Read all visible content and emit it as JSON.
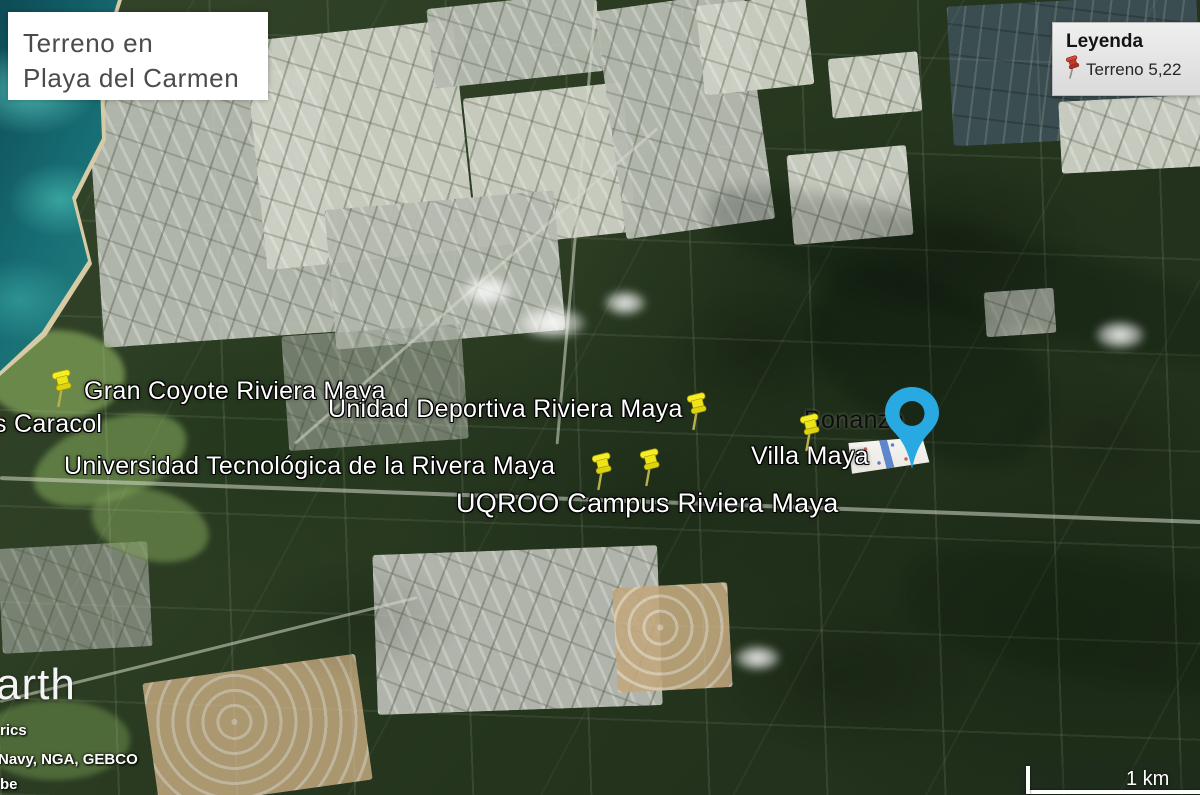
{
  "title_card": {
    "line1": "Terreno en",
    "line2": "Playa del Carmen"
  },
  "legend": {
    "title": "Leyenda",
    "item_label": "Terreno 5,22"
  },
  "map_labels": {
    "gran_coyote": "Gran Coyote Riviera Maya",
    "caracol": "s Caracol",
    "unidad_deportiva": "Unidad Deportiva Riviera Maya",
    "universidad": "Universidad Tecnológica de la Rivera Maya",
    "uqroo": "UQROO Campus Riviera Maya",
    "villa_maya": "Villa Maya",
    "bonanza": "Bonanza"
  },
  "watermark": {
    "partial_text": "arth"
  },
  "attribution": {
    "line1": "rics",
    "line2": "Navy, NGA, GEBCO",
    "line3": "be"
  },
  "scale_bar": {
    "label": "1 km"
  },
  "colors": {
    "marker_blue": "#29A9E1",
    "pushpin_yellow": "#F2E91C",
    "legend_pin_red": "#C0392B",
    "ocean_teal": "#1E6F75",
    "jungle_green": "#2A3A22",
    "urban_gray": "#B6BAB0"
  }
}
